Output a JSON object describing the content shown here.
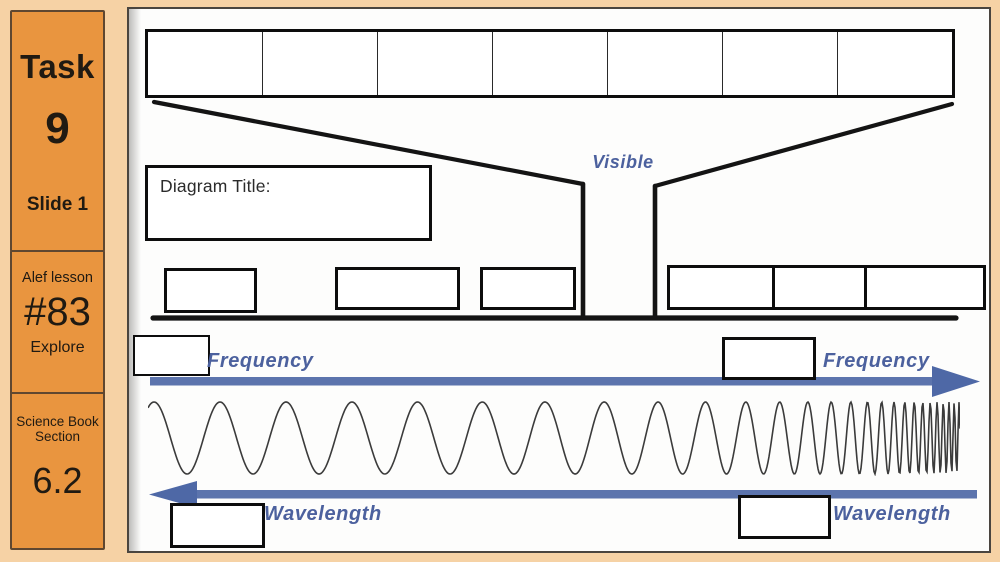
{
  "colors": {
    "page_background": "#f6d2a5",
    "sidebar_fill": "#e9953f",
    "sidebar_border": "#5f4730",
    "accent_blue": "#4e68a6",
    "label_blue": "#4c619e",
    "line_black": "#141414",
    "wave_gray": "#3b3b3b"
  },
  "sidebar": {
    "task_label": "Task",
    "task_number": "9",
    "slide_label": "Slide 1",
    "lesson_label": "Alef lesson",
    "lesson_number": "#83",
    "lesson_phase": "Explore",
    "book_line1": "Science Book",
    "book_line2": "Section",
    "book_section": "6.2"
  },
  "diagram": {
    "title_box_label": "Diagram Title:",
    "visible_label": "Visible",
    "frequency_label_left": "Frequency",
    "frequency_label_right": "Frequency",
    "wavelength_label_left": "Wavelength",
    "wavelength_label_right": "Wavelength",
    "spectrum_table_columns": 7,
    "spectrum_table_cells": [
      "",
      "",
      "",
      "",
      "",
      "",
      ""
    ]
  },
  "wave": {
    "type": "chirp",
    "period_start_px": 66,
    "period_end_px": 4.6,
    "amplitude_px": 36,
    "curve_power": 5,
    "start_phase_rad": 0.9
  }
}
